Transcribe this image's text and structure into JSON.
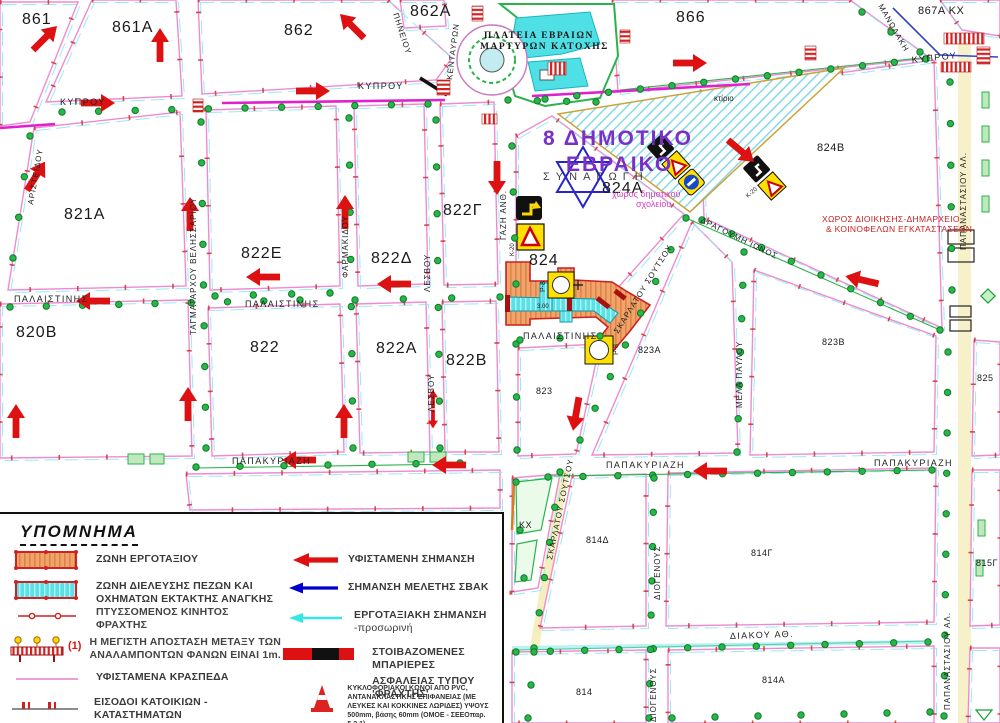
{
  "map": {
    "block_labels": {
      "b861": "861",
      "b861a": "861Α",
      "b862": "862",
      "b862a": "862Α",
      "b866": "866",
      "b867a": "867Α ΚΧ",
      "b821a": "821Α",
      "b822g": "822Γ",
      "b822e": "822Ε",
      "b822d": "822Δ",
      "b824": "824",
      "b824a": "824Α",
      "b824b": "824Β",
      "b820b": "820Β",
      "b822": "822",
      "b822a": "822Α",
      "b822b": "822Β",
      "b823": "823",
      "b823a": "823Α",
      "b823b": "823Β",
      "b825": "825",
      "b814d": "814Δ",
      "b814g": "814Γ",
      "b815g": "815Γ",
      "b814": "814",
      "b814a": "814Α",
      "kx": "ΚΧ"
    },
    "street_labels": {
      "kyprou": "ΚΥΠΡΟΥ",
      "pineiou": "ΠΗΝΕΙΟΥ",
      "manolaki": "ΜΑΝΩΛΑΚΗ",
      "kentavron": "ΚΕΝΤΑΥΡΩΝ",
      "aristeidou": "ΑΡΙΣΤΕΙΔΟΥ",
      "velissariou": "ΤΑΓΜΑΤΑΡΧΟΥ ΒΕΛΗΣΣΑΡΙΟΥ",
      "farmakidou": "ΦΑΡΜΑΚΙΔΟΥ",
      "lesvou": "ΛΕΣΒΟΥ",
      "palaistinis": "ΠΑΛΑΙΣΤΙΝΗΣ",
      "gazi": "ΓΑΖΗ ΑΝΘ.",
      "soutsou": "ΣΚΑΡΛΑΤΟΥ ΣΟΥΤΣΟΥ",
      "dragoumi": "ΔΡΑΓΟΥΜΗ ΙΩΝΟΣ",
      "papakyriazi": "ΠΑΠΑΚΥΡΙΑΖΗ",
      "melapavlou": "ΜΕΛΑ ΠΑΥΛΟΥ",
      "diogenous": "ΔΙΟΓΕΝΟΥΣ",
      "diakou": "ΔΙΑΚΟΥ ΑΘ.",
      "papanastasiou": "ΠΑΠΑΝΑΣΤΑΣΙΟΥ ΑΛ."
    },
    "place_labels": {
      "plateia1": "ΠΛΑΤΕΙΑ ΕΒΡΑΙΩΝ",
      "plateia2": "ΜΑΡΤΥΡΩΝ ΚΑΤΟΧΗΣ",
      "school1": "8 ΔΗΜΟΤΙΚΟ",
      "school2": "ΕΒΡΑΙΚΟ",
      "synagogue": "ΣΥΝΑΓΩΓΗ",
      "school_area1": "χώρος δημοτικού",
      "school_area2": "σχολείου",
      "admin1": "ΧΩΡΟΣ ΔΙΟΙΚΗΣΗΣ-ΔΗΜΑΡΧΕΙΟ",
      "admin2": "& ΚΟΙΝΟΦΕΛΩΝ ΕΓΚΑΤΑΣΤΑΣΕΩΝ",
      "ktirio": "κτίριο",
      "k20": "Κ-20",
      "p8": "Ρ-8",
      "dim1": "3.00"
    }
  },
  "legend": {
    "title": "ΥΠΟΜΝΗΜΑ",
    "left": [
      {
        "l1": "ΖΩΝΗ  ΕΡΓΟΤΑΞΙΟΥ"
      },
      {
        "l1": "ΖΩΝΗ  ΔΙΕΛΕΥΣΗΣ ΠΕΖΩΝ ΚΑΙ",
        "l2": "ΟΧΗΜΑΤΩΝ ΕΚΤΑΚΤΗΣ ΑΝΑΓΚΗΣ"
      },
      {
        "l1": "ΠΤΥΣΣΟΜΕΝΟΣ ΚΙΝΗΤΟΣ",
        "l2": "ΦΡΑΧΤΗΣ"
      },
      {
        "num": "(1)",
        "l1": "Η ΜΕΓΙΣΤΗ ΑΠΟΣΤΑΣΗ ΜΕΤΑΞΥ ΤΩΝ",
        "l2": "ΑΝΑΛΑΜΠΟΝΤΩΝ ΦΑΝΩΝ ΕΙΝΑΙ 1m."
      },
      {
        "l1": "ΥΦΙΣΤΑΜΕΝΑ ΚΡΑΣΠΕΔΑ"
      },
      {
        "l1": "ΕΙΣΟΔΟΙ ΚΑΤΟΙΚΙΩΝ -",
        "l2": "ΚΑΤΑΣΤΗΜΑΤΩΝ"
      }
    ],
    "right": [
      {
        "l1": "ΥΦΙΣΤΑΜΕΝΗ ΣΗΜΑΝΣΗ"
      },
      {
        "l1": "ΣΗΜΑΝΣΗ ΜΕΛΕΤΗΣ ΣΒΑΚ"
      },
      {
        "l1": "ΕΡΓΟΤΑΞΙΑΚΗ ΣΗΜΑΝΣΗ",
        "l2": "-προσωρινή"
      },
      {
        "l1": "ΣΤΟΙΒΑΖΟΜΕΝΕΣ ΜΠΑΡΙΕΡΕΣ",
        "l2": "ΑΣΦΑΛΕΙΑΣ ΤΥΠΟΥ 'ΦΡΑΧΤΗΣ'"
      },
      {
        "l1": "ΚΥΚΛΟΦΟΡΙΑΚΟΙ ΚΩΝΟΙ ΑΠΟ PVC,",
        "l2": "ΑΝΤΑΝΑΚΛΑΣΤΙΚΗΣ ΕΠΙΦΑΝΕΙΑΣ (ΜΕ",
        "l3": "ΛΕΥΚΕΣ ΚΑΙ ΚΟΚΚΙΝΕΣ ΛΩΡΙΔΕΣ) ΥΨΟΥΣ",
        "l4": "500mm, βάσης 60mm (ΟΜΟΕ - ΣΕΕΟπαρ. 5.2.1)"
      }
    ],
    "colors": {
      "existing": "#dd1111",
      "svak": "#0000cc",
      "temporary": "#35e6e6",
      "work_zone": "#f2a369",
      "ped_zone": "#5ce0e8",
      "curb": "#e87ec8"
    }
  }
}
